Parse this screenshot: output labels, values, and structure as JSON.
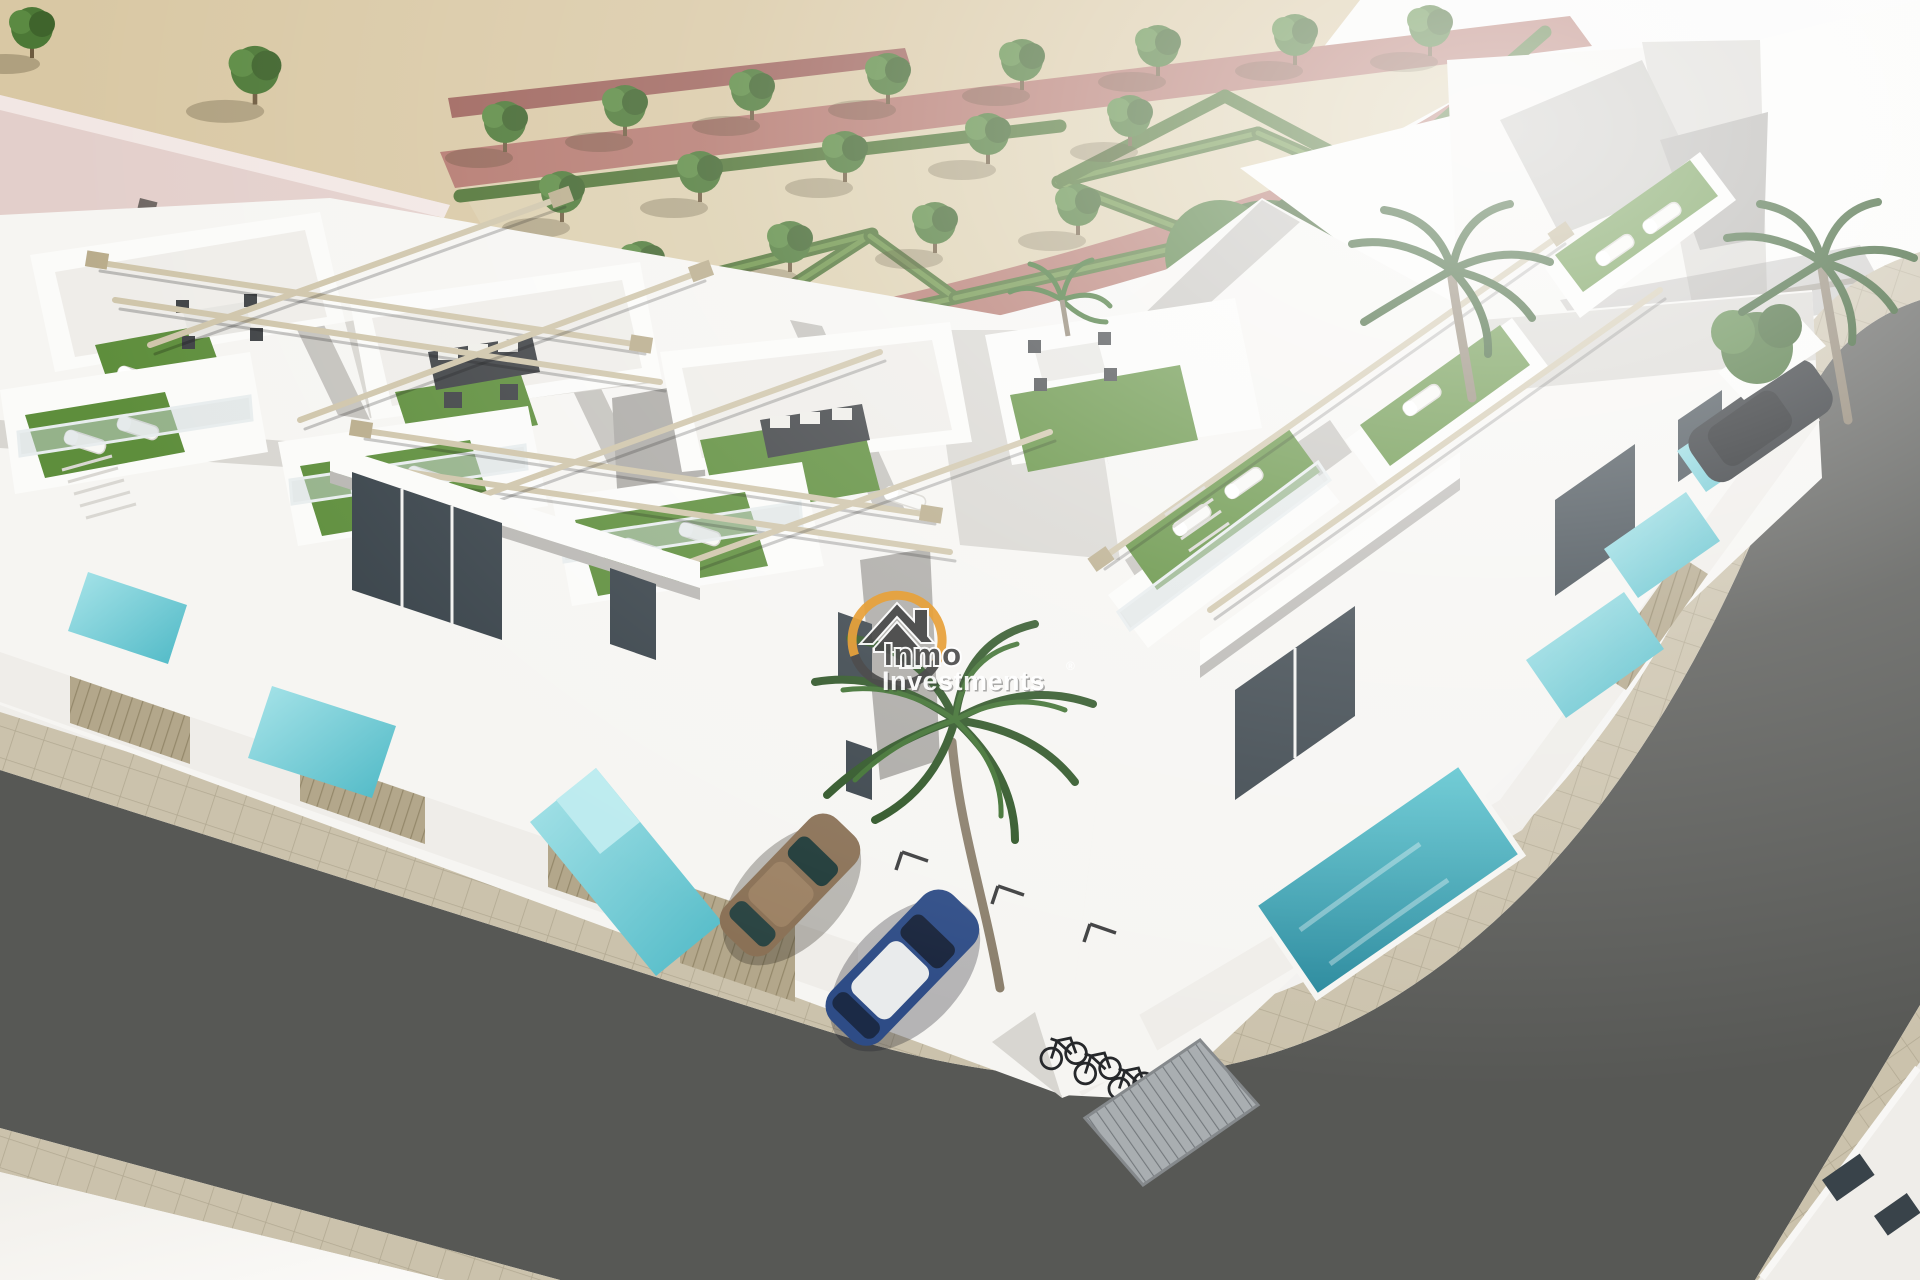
{
  "meta": {
    "type": "3d-architectural-render",
    "subject": "Aerial corner view of a new-build white townhouse development with rooftop solariums, private pools, parking court, landscaped formal park and surrounding streets"
  },
  "watermark": {
    "line1": "Inmo",
    "line2": "Investments",
    "registered": "®",
    "arc_gold": "#E8A23B",
    "arc_dark": "#4E4E4E",
    "text_dark": "#4F4F4F",
    "text_light": "#FFFFFF"
  },
  "palette": {
    "sand": "#D9C8A4",
    "park_ground": "#DCCFAE",
    "path_rose": "#B3766C",
    "path_rose_dark": "#9D625A",
    "hedge": "#4E7233",
    "hedge_light": "#6B9246",
    "tree": "#4C7836",
    "turf": "#5E8E3C",
    "pool_light": "#8ED7DE",
    "pool_deep": "#2F9AA8",
    "asphalt": "#575855",
    "sidewalk": "#CBC2AC",
    "facade_white": "#F6F5F2",
    "facade_shade": "#D8D6D1",
    "glass": "#39434A",
    "wood_fence": "#B3A78B",
    "pergola": "#CFC5AA",
    "roof_pink": "#E3CFCB",
    "car_bronze": "#8A7156",
    "car_blue": "#2E4C86",
    "car_dark": "#22262A"
  },
  "scene": {
    "counts": {
      "rooftop_terraces": 9,
      "private_pools": 7,
      "cars": 3,
      "bicycles": 3,
      "palm_trees": 4,
      "park_trees": 19
    }
  }
}
